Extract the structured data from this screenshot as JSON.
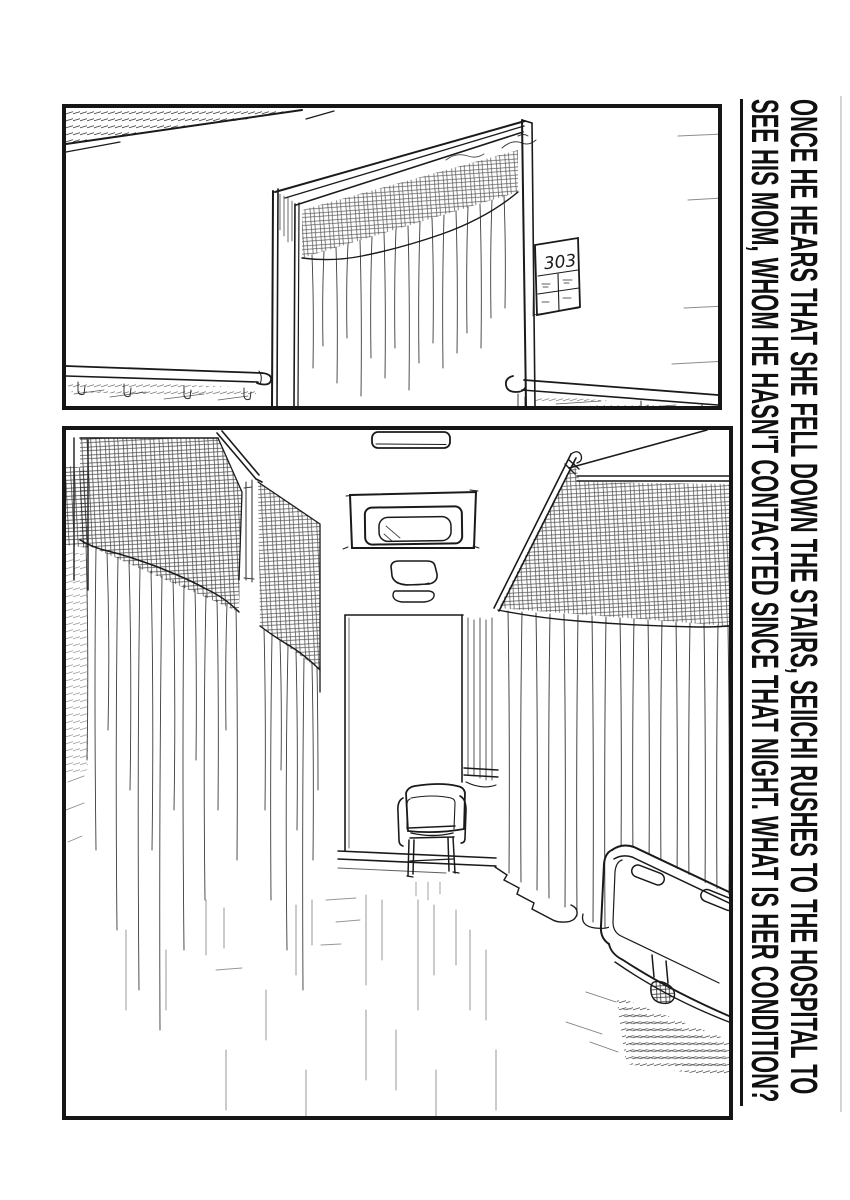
{
  "page": {
    "paper_color": "#ffffff",
    "ink_color": "#1a1a1a"
  },
  "caption": {
    "line1": "ONCE HE HEARS THAT SHE FELL DOWN THE STAIRS, SEIICHI RUSHES TO THE HOSPITAL TO",
    "line2": "SEE HIS MOM, WHOM HE HASN'T CONTACTED SINCE THAT NIGHT. WHAT IS HER CONDITION?"
  },
  "panels": {
    "top": {
      "label": "hospital corridor with open door and handrails",
      "room_sign": "303"
    },
    "bottom": {
      "label": "hospital ward aisle with privacy curtains, chair and bed"
    }
  }
}
